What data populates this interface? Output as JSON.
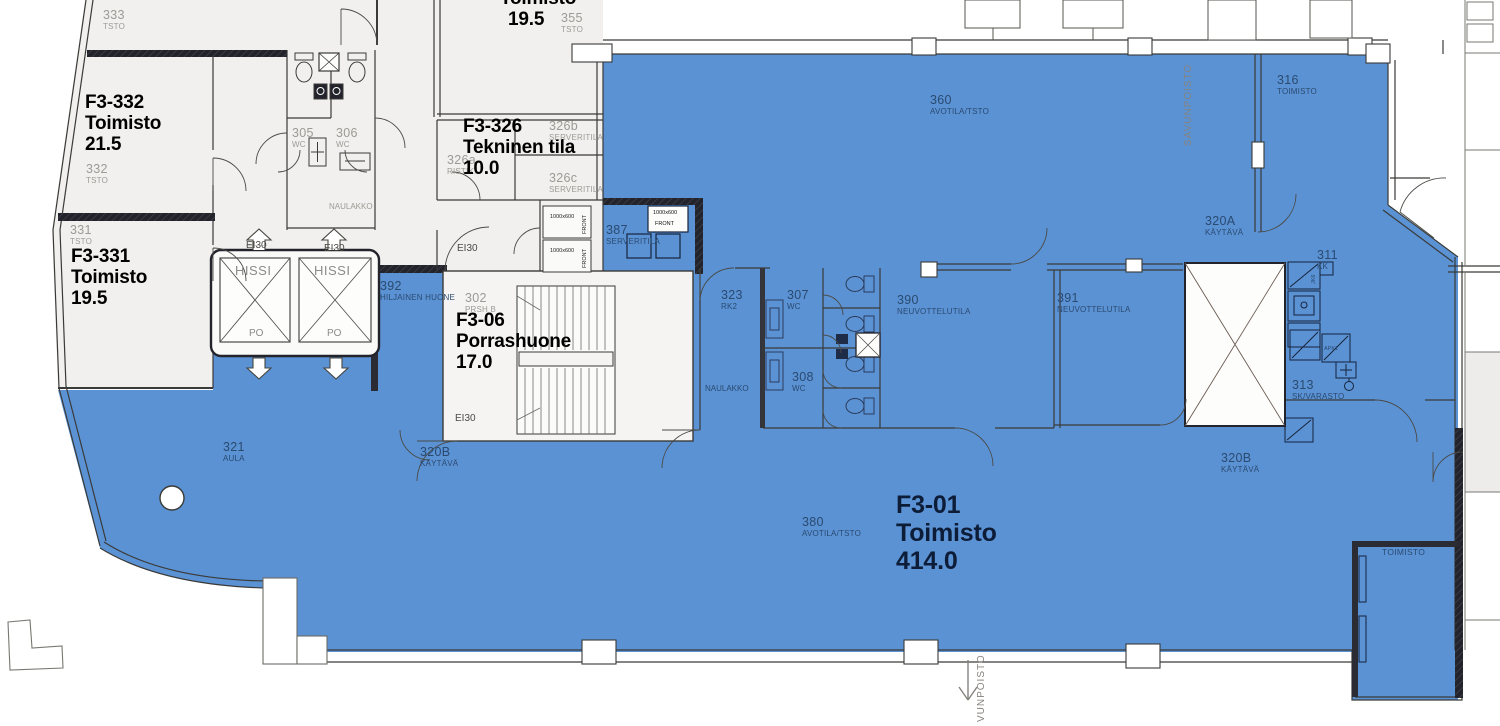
{
  "meta": {
    "drawing_type": "floor-plan",
    "floor": "3"
  },
  "palette": {
    "highlight_blue": "#5B92D4",
    "room_fill": "#F1F0EE",
    "stair_fill": "#F5F4F2",
    "wall": "#3A3A38",
    "dark_wall": "#23232B",
    "label_on_blue": "#2A4A70",
    "label_gray": "#9C9A94",
    "label_black": "#0D1D38"
  },
  "rooms": {
    "f3_332": {
      "id": "F3-332",
      "name": "Toimisto",
      "area": "21.5"
    },
    "f3_331": {
      "id": "F3-331",
      "name": "Toimisto",
      "area": "19.5"
    },
    "toimisto_top": {
      "name": "Toimisto",
      "area": "19.5"
    },
    "f3_326": {
      "id": "F3-326",
      "name": "Tekninen tila",
      "area": "10.0"
    },
    "f3_06": {
      "id": "F3-06",
      "name": "Porrashuone",
      "area": "17.0"
    },
    "f3_01": {
      "id": "F3-01",
      "name": "Toimisto",
      "area": "414.0"
    }
  },
  "labels": {
    "r333": {
      "num": "333",
      "type": "TSTO"
    },
    "r332": {
      "num": "332",
      "type": "TSTO"
    },
    "r331": {
      "num": "331",
      "type": "TSTO"
    },
    "r355": {
      "num": "355",
      "type": "TSTO"
    },
    "r305": {
      "num": "305",
      "type": "WC"
    },
    "r306": {
      "num": "306",
      "type": "WC"
    },
    "r326a": {
      "num": "326a",
      "type": "RISTIK."
    },
    "r326b": {
      "num": "326b",
      "type": "SERVERITILA"
    },
    "r326c": {
      "num": "326c",
      "type": "SERVERITILA"
    },
    "r387": {
      "num": "387",
      "type": "SERVERITILA"
    },
    "r392": {
      "num": "392",
      "type": "HILJAINEN HUONE"
    },
    "r302": {
      "num": "302",
      "type": "PRSH B"
    },
    "r360": {
      "num": "360",
      "type": "AVOTILA/TSTO"
    },
    "r316": {
      "num": "316",
      "type": "TOIMISTO"
    },
    "r320a": {
      "num": "320A",
      "type": "KÄYTÄVÄ"
    },
    "r311": {
      "num": "311",
      "type": "KK"
    },
    "r390": {
      "num": "390",
      "type": "NEUVOTTELUTILA"
    },
    "r391": {
      "num": "391",
      "type": "NEUVOTTELUTILA"
    },
    "r323": {
      "num": "323",
      "type": "RK2"
    },
    "r307": {
      "num": "307",
      "type": "WC"
    },
    "r308": {
      "num": "308",
      "type": "WC"
    },
    "r313": {
      "num": "313",
      "type": "SK/VARASTO"
    },
    "r321": {
      "num": "321",
      "type": "AULA"
    },
    "r320b": {
      "num": "320B",
      "type": "KÄYTÄVÄ"
    },
    "r380": {
      "num": "380",
      "type": "AVOTILA/TSTO"
    },
    "naulakko": "NAULAKKO",
    "toimisto_plain": "TOIMISTO",
    "hissi": "HISSI",
    "po": "PO",
    "ei30": "EI30",
    "rack_size": "1000x600",
    "rack_front": "FRONT",
    "apk": "APK1",
    "jk": "JK6",
    "savunpoisto": "SAVUNPOISTO",
    "vunpoisto": "VUNPOISTO"
  }
}
